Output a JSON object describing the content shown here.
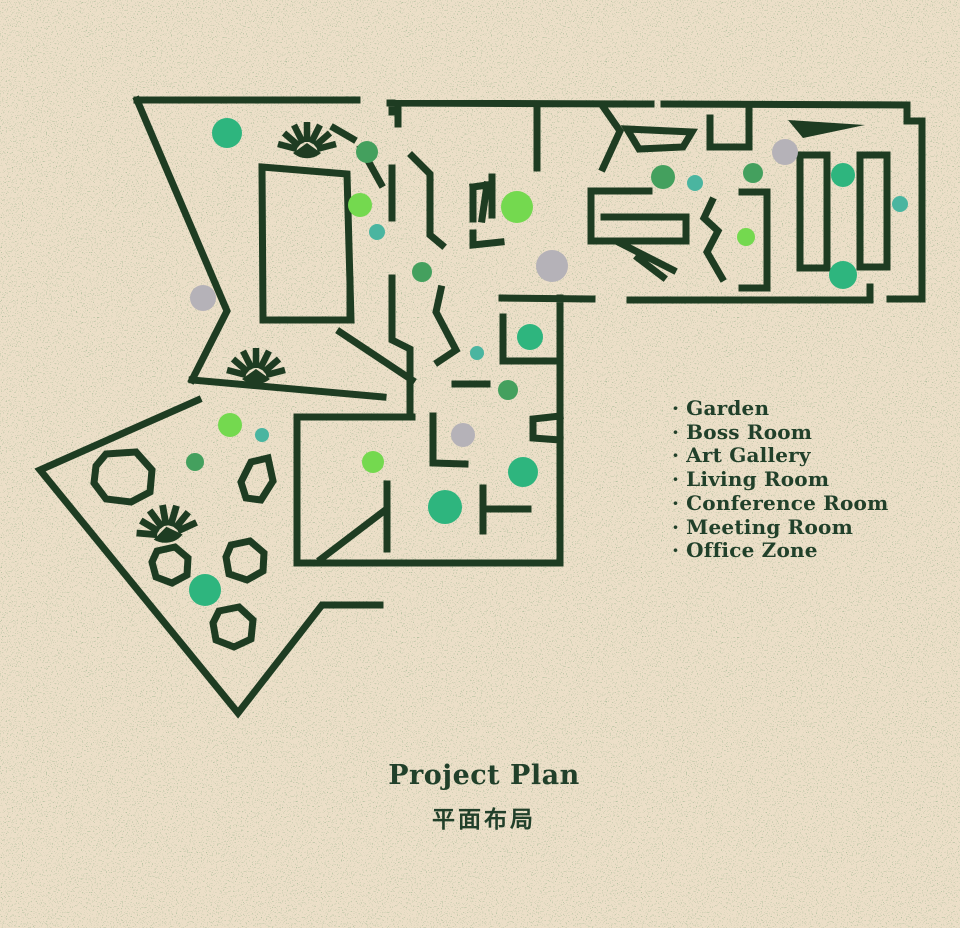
{
  "title": {
    "en": "Project Plan",
    "zh": "平面布局"
  },
  "legend": {
    "bullet": "·",
    "items": [
      "Garden",
      "Boss Room",
      "Art Gallery",
      "Living Room",
      "Conference Room",
      "Meeting Room",
      "Office Zone"
    ]
  },
  "palette": {
    "background": "#ecdfc8",
    "wall": "#1e3c22",
    "text": "#21402a",
    "green": "#2eb57e",
    "leaf": "#44a05e",
    "lime": "#74d94f",
    "teal": "#4ab5a0",
    "gray": "#b5b2b8"
  },
  "plan": {
    "markers": [
      {
        "x": 227,
        "y": 133,
        "r": 15,
        "c": "green"
      },
      {
        "x": 203,
        "y": 298,
        "r": 13,
        "c": "gray"
      },
      {
        "x": 367,
        "y": 152,
        "r": 11,
        "c": "leaf"
      },
      {
        "x": 360,
        "y": 205,
        "r": 12,
        "c": "lime"
      },
      {
        "x": 377,
        "y": 232,
        "r": 8,
        "c": "teal"
      },
      {
        "x": 422,
        "y": 272,
        "r": 10,
        "c": "leaf"
      },
      {
        "x": 517,
        "y": 207,
        "r": 16,
        "c": "lime"
      },
      {
        "x": 552,
        "y": 266,
        "r": 16,
        "c": "gray"
      },
      {
        "x": 530,
        "y": 337,
        "r": 13,
        "c": "green"
      },
      {
        "x": 477,
        "y": 353,
        "r": 7,
        "c": "teal"
      },
      {
        "x": 508,
        "y": 390,
        "r": 10,
        "c": "leaf"
      },
      {
        "x": 463,
        "y": 435,
        "r": 12,
        "c": "gray"
      },
      {
        "x": 373,
        "y": 462,
        "r": 11,
        "c": "lime"
      },
      {
        "x": 523,
        "y": 472,
        "r": 15,
        "c": "green"
      },
      {
        "x": 445,
        "y": 507,
        "r": 17,
        "c": "green"
      },
      {
        "x": 663,
        "y": 177,
        "r": 12,
        "c": "leaf"
      },
      {
        "x": 695,
        "y": 183,
        "r": 8,
        "c": "teal"
      },
      {
        "x": 753,
        "y": 173,
        "r": 10,
        "c": "leaf"
      },
      {
        "x": 785,
        "y": 152,
        "r": 13,
        "c": "gray"
      },
      {
        "x": 843,
        "y": 175,
        "r": 12,
        "c": "green"
      },
      {
        "x": 900,
        "y": 204,
        "r": 8,
        "c": "teal"
      },
      {
        "x": 746,
        "y": 237,
        "r": 9,
        "c": "lime"
      },
      {
        "x": 843,
        "y": 275,
        "r": 14,
        "c": "green"
      },
      {
        "x": 230,
        "y": 425,
        "r": 12,
        "c": "lime"
      },
      {
        "x": 262,
        "y": 435,
        "r": 7,
        "c": "teal"
      },
      {
        "x": 195,
        "y": 462,
        "r": 9,
        "c": "leaf"
      },
      {
        "x": 205,
        "y": 590,
        "r": 16,
        "c": "green"
      }
    ]
  }
}
